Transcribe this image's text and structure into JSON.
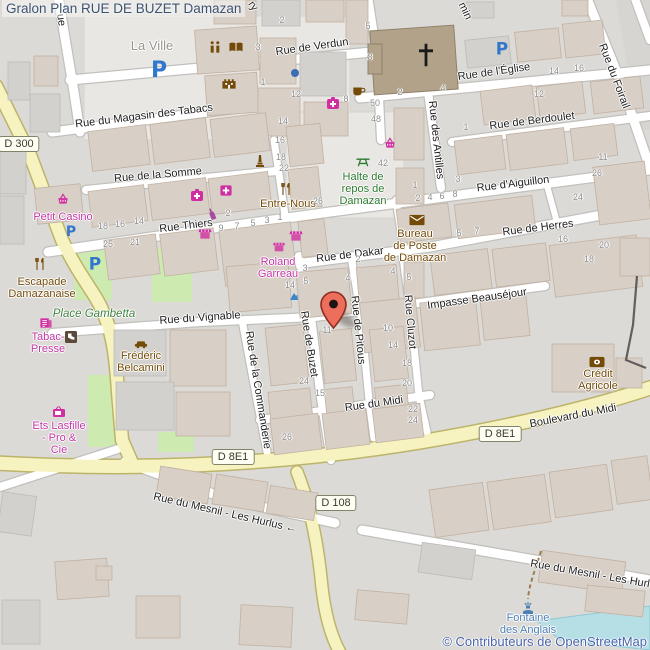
{
  "title": "Gralon Plan RUE DE BUZET Damazan",
  "attribution": "© Contributeurs de OpenStreetMap",
  "colors": {
    "background": "#dcdad6",
    "pedestrian_area": "#e9e7e3",
    "building": "#d8cfc6",
    "road_major": "#f6f3c0",
    "road_minor": "#ffffff",
    "green_area": "#cdebb0",
    "water": "#b5dfe5",
    "church": "#b2a28a",
    "shop_label": "#c135a6",
    "amenity_label": "#734a08",
    "leisure_label": "#2c7a30",
    "water_label": "#4d80b4",
    "parking_icon": "#3377cc",
    "marker": "#ee6e5c",
    "title_text": "#3c5271",
    "attribution_text": "#4a64ad"
  },
  "marker": {
    "icon": "location-pin",
    "nearby_house_number": "11"
  },
  "road_badges": [
    {
      "text": "D 300",
      "x": 19,
      "y": 144
    },
    {
      "text": "D 8E1",
      "x": 233,
      "y": 457
    },
    {
      "text": "D 8E1",
      "x": 500,
      "y": 434
    },
    {
      "text": "D 108",
      "x": 336,
      "y": 503
    }
  ],
  "street_labels": [
    {
      "text": "Rue de Verdun",
      "x": 312,
      "y": 47,
      "rot": -8
    },
    {
      "text": "Rue de l'Église",
      "x": 494,
      "y": 72,
      "rot": -8
    },
    {
      "text": "Rue du Foirail",
      "x": 614,
      "y": 76,
      "rot": 69
    },
    {
      "text": "Rue de Berdoulet",
      "x": 532,
      "y": 121,
      "rot": -7
    },
    {
      "text": "Rue des Antilles",
      "x": 436,
      "y": 140,
      "rot": 84
    },
    {
      "text": "Rue d'Aiguillon",
      "x": 513,
      "y": 184,
      "rot": -7
    },
    {
      "text": "Rue du Magasin des Tabacs",
      "x": 144,
      "y": 116,
      "rot": -7
    },
    {
      "text": "Rue de la Somme",
      "x": 158,
      "y": 175,
      "rot": -5
    },
    {
      "text": "Rue Thiers",
      "x": 186,
      "y": 226,
      "rot": -7
    },
    {
      "text": "Rue de Dakar",
      "x": 350,
      "y": 255,
      "rot": -7
    },
    {
      "text": "Rue de Herres",
      "x": 538,
      "y": 228,
      "rot": -7
    },
    {
      "text": "Impasse Beauséjour",
      "x": 477,
      "y": 299,
      "rot": -8
    },
    {
      "text": "Rue du Vignable",
      "x": 200,
      "y": 318,
      "rot": -4
    },
    {
      "text": "Rue de Buzet",
      "x": 309,
      "y": 344,
      "rot": 81
    },
    {
      "text": "Rue de Pitous",
      "x": 358,
      "y": 330,
      "rot": 84
    },
    {
      "text": "Rue Cluzot",
      "x": 410,
      "y": 322,
      "rot": 85
    },
    {
      "text": "Rue de la Commanderie",
      "x": 258,
      "y": 390,
      "rot": 81
    },
    {
      "text": "Rue du Midi",
      "x": 374,
      "y": 404,
      "rot": -8
    },
    {
      "text": "Boulevard du Midi",
      "x": 573,
      "y": 416,
      "rot": -11
    },
    {
      "text": "Rue du Mesnil - Les Hurlus ←",
      "x": 225,
      "y": 513,
      "rot": 13
    },
    {
      "text": "Rue du Mesnil - Les Hurl",
      "x": 590,
      "y": 574,
      "rot": 10
    },
    {
      "text": "ue",
      "x": 61,
      "y": 20,
      "rot": 82
    },
    {
      "text": "ry",
      "x": 253,
      "y": 6,
      "rot": 55
    },
    {
      "text": "min",
      "x": 465,
      "y": 11,
      "rot": 65
    }
  ],
  "poi_labels": [
    {
      "lines": [
        "La Ville"
      ],
      "x": 152,
      "y": 39,
      "cls": "place"
    },
    {
      "lines": [
        "Petit Casino"
      ],
      "x": 63,
      "y": 212,
      "cls": "shop"
    },
    {
      "lines": [
        "Escapade",
        "Damazanaise"
      ],
      "x": 42,
      "y": 277,
      "cls": "amen"
    },
    {
      "lines": [
        "Place Gambetta"
      ],
      "x": 94,
      "y": 308,
      "cls": "square"
    },
    {
      "lines": [
        "Tabac-",
        "Presse"
      ],
      "x": 48,
      "y": 332,
      "cls": "shop"
    },
    {
      "lines": [
        "Frédéric",
        "Belcamini"
      ],
      "x": 141,
      "y": 351,
      "cls": "amen"
    },
    {
      "lines": [
        "Ets Lasfille",
        "- Pro &",
        "Cie"
      ],
      "x": 59,
      "y": 421,
      "cls": "shop"
    },
    {
      "lines": [
        "Roland",
        "Garreau"
      ],
      "x": 278,
      "y": 257,
      "cls": "shop"
    },
    {
      "lines": [
        "Entre-Nous"
      ],
      "x": 288,
      "y": 199,
      "cls": "amen"
    },
    {
      "lines": [
        "Halte de",
        "repos de",
        "Damazan"
      ],
      "x": 363,
      "y": 172,
      "cls": "leis"
    },
    {
      "lines": [
        "Bureau",
        "de Poste",
        "de Damazan"
      ],
      "x": 415,
      "y": 229,
      "cls": "amen"
    },
    {
      "lines": [
        "Crédit",
        "Agricole"
      ],
      "x": 598,
      "y": 369,
      "cls": "amen"
    },
    {
      "lines": [
        "Fontaine",
        "des Anglais"
      ],
      "x": 528,
      "y": 613,
      "cls": "wat"
    }
  ],
  "icons": [
    {
      "type": "parking",
      "x": 159,
      "y": 71,
      "s": 22
    },
    {
      "type": "parking",
      "x": 502,
      "y": 50,
      "s": 17
    },
    {
      "type": "parking",
      "x": 71,
      "y": 232,
      "s": 14
    },
    {
      "type": "parking",
      "x": 95,
      "y": 265,
      "s": 17
    },
    {
      "type": "cross",
      "x": 426,
      "y": 55,
      "s": 24
    },
    {
      "type": "pharmacy",
      "x": 333,
      "y": 103,
      "s": 14
    },
    {
      "type": "pharmacy",
      "x": 197,
      "y": 195,
      "s": 14
    },
    {
      "type": "firstaid",
      "x": 226,
      "y": 190,
      "s": 13
    },
    {
      "type": "basket",
      "x": 63,
      "y": 199,
      "s": 13
    },
    {
      "type": "basket",
      "x": 390,
      "y": 143,
      "s": 13
    },
    {
      "type": "awning",
      "x": 205,
      "y": 234,
      "s": 13
    },
    {
      "type": "awning",
      "x": 296,
      "y": 236,
      "s": 13
    },
    {
      "type": "awning",
      "x": 279,
      "y": 247,
      "s": 12
    },
    {
      "type": "forkknife",
      "x": 40,
      "y": 264,
      "s": 14
    },
    {
      "type": "forkknife",
      "x": 286,
      "y": 189,
      "s": 14
    },
    {
      "type": "book",
      "x": 236,
      "y": 47,
      "s": 15
    },
    {
      "type": "statue",
      "x": 215,
      "y": 47,
      "s": 15
    },
    {
      "type": "castle",
      "x": 229,
      "y": 83,
      "s": 15
    },
    {
      "type": "monument",
      "x": 260,
      "y": 161,
      "s": 14
    },
    {
      "type": "bottle",
      "x": 212,
      "y": 214,
      "s": 13,
      "rot": -22
    },
    {
      "type": "cup",
      "x": 359,
      "y": 91,
      "s": 14
    },
    {
      "type": "envelope",
      "x": 417,
      "y": 220,
      "s": 15
    },
    {
      "type": "bank",
      "x": 597,
      "y": 362,
      "s": 15
    },
    {
      "type": "picnic",
      "x": 363,
      "y": 162,
      "s": 15
    },
    {
      "type": "tv",
      "x": 59,
      "y": 412,
      "s": 14
    },
    {
      "type": "newspaper",
      "x": 46,
      "y": 323,
      "s": 13
    },
    {
      "type": "darkshop",
      "x": 71,
      "y": 337,
      "s": 12
    },
    {
      "type": "car",
      "x": 141,
      "y": 344,
      "s": 14
    },
    {
      "type": "fountain",
      "x": 528,
      "y": 608,
      "s": 14
    },
    {
      "type": "waterjet",
      "x": 294,
      "y": 296,
      "s": 12
    },
    {
      "type": "dot",
      "x": 295,
      "y": 73,
      "s": 8
    }
  ],
  "house_numbers": [
    {
      "t": "2",
      "x": 282,
      "y": 20
    },
    {
      "t": "5",
      "x": 368,
      "y": 26
    },
    {
      "t": "3",
      "x": 370,
      "y": 57
    },
    {
      "t": "3",
      "x": 258,
      "y": 47
    },
    {
      "t": "1",
      "x": 263,
      "y": 82
    },
    {
      "t": "12",
      "x": 296,
      "y": 94
    },
    {
      "t": "8",
      "x": 346,
      "y": 99
    },
    {
      "t": "14",
      "x": 283,
      "y": 121
    },
    {
      "t": "50",
      "x": 375,
      "y": 103
    },
    {
      "t": "48",
      "x": 376,
      "y": 119
    },
    {
      "t": "42",
      "x": 383,
      "y": 163
    },
    {
      "t": "2",
      "x": 400,
      "y": 92
    },
    {
      "t": "4",
      "x": 443,
      "y": 88
    },
    {
      "t": "14",
      "x": 554,
      "y": 71
    },
    {
      "t": "16",
      "x": 579,
      "y": 68
    },
    {
      "t": "12",
      "x": 539,
      "y": 94
    },
    {
      "t": "1",
      "x": 466,
      "y": 127
    },
    {
      "t": "11",
      "x": 603,
      "y": 157
    },
    {
      "t": "26",
      "x": 597,
      "y": 173
    },
    {
      "t": "24",
      "x": 578,
      "y": 197
    },
    {
      "t": "16",
      "x": 280,
      "y": 140
    },
    {
      "t": "18",
      "x": 281,
      "y": 157
    },
    {
      "t": "22",
      "x": 284,
      "y": 168
    },
    {
      "t": "26",
      "x": 318,
      "y": 201
    },
    {
      "t": "18",
      "x": 103,
      "y": 226
    },
    {
      "t": "16",
      "x": 120,
      "y": 224
    },
    {
      "t": "14",
      "x": 139,
      "y": 221
    },
    {
      "t": "25",
      "x": 108,
      "y": 244
    },
    {
      "t": "21",
      "x": 135,
      "y": 242
    },
    {
      "t": "2",
      "x": 228,
      "y": 213
    },
    {
      "t": "9",
      "x": 221,
      "y": 228
    },
    {
      "t": "7",
      "x": 237,
      "y": 226
    },
    {
      "t": "5",
      "x": 253,
      "y": 223
    },
    {
      "t": "3",
      "x": 267,
      "y": 220
    },
    {
      "t": "1",
      "x": 280,
      "y": 217
    },
    {
      "t": "1",
      "x": 415,
      "y": 185
    },
    {
      "t": "3",
      "x": 458,
      "y": 179
    },
    {
      "t": "2",
      "x": 418,
      "y": 198
    },
    {
      "t": "4",
      "x": 430,
      "y": 197
    },
    {
      "t": "6",
      "x": 442,
      "y": 196
    },
    {
      "t": "8",
      "x": 455,
      "y": 194
    },
    {
      "t": "5",
      "x": 459,
      "y": 233
    },
    {
      "t": "7",
      "x": 477,
      "y": 231
    },
    {
      "t": "16",
      "x": 563,
      "y": 239
    },
    {
      "t": "20",
      "x": 604,
      "y": 245
    },
    {
      "t": "18",
      "x": 589,
      "y": 259
    },
    {
      "t": "3",
      "x": 305,
      "y": 268
    },
    {
      "t": "5",
      "x": 306,
      "y": 281
    },
    {
      "t": "14",
      "x": 290,
      "y": 285
    },
    {
      "t": "4",
      "x": 348,
      "y": 278
    },
    {
      "t": "2",
      "x": 358,
      "y": 259
    },
    {
      "t": "4",
      "x": 393,
      "y": 271
    },
    {
      "t": "5",
      "x": 409,
      "y": 277
    },
    {
      "t": "11",
      "x": 327,
      "y": 330
    },
    {
      "t": "10",
      "x": 388,
      "y": 328
    },
    {
      "t": "14",
      "x": 393,
      "y": 345
    },
    {
      "t": "18",
      "x": 407,
      "y": 363
    },
    {
      "t": "20",
      "x": 407,
      "y": 383
    },
    {
      "t": "24",
      "x": 304,
      "y": 381
    },
    {
      "t": "15",
      "x": 320,
      "y": 393
    },
    {
      "t": "22",
      "x": 413,
      "y": 409
    },
    {
      "t": "24",
      "x": 413,
      "y": 420
    },
    {
      "t": "26",
      "x": 287,
      "y": 437
    }
  ]
}
